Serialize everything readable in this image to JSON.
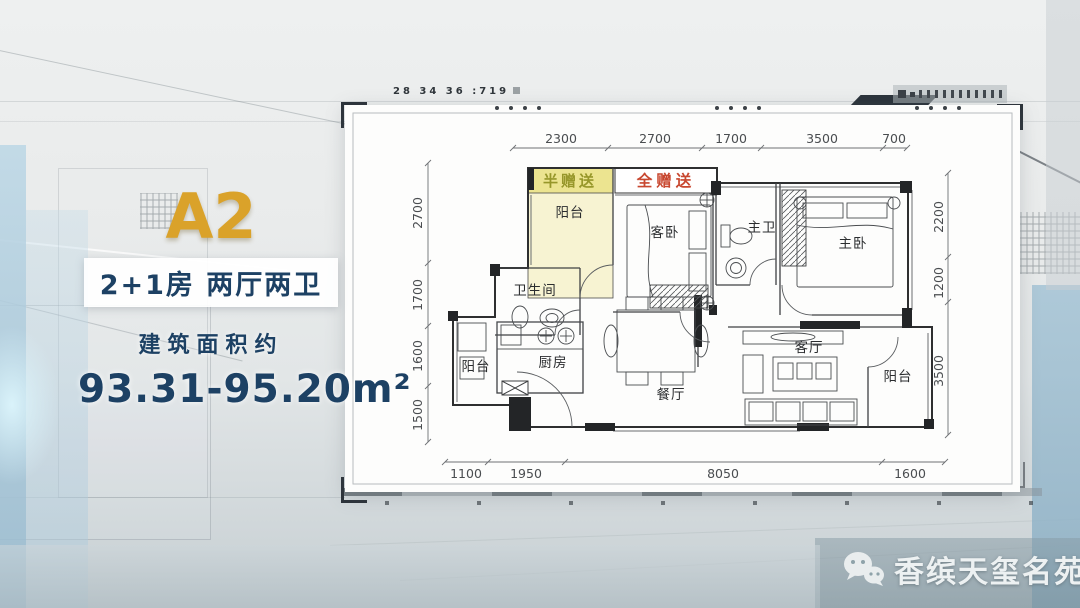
{
  "panel": {
    "unit": "A2",
    "layout": "2+1房  两厅两卫",
    "area_label": "建筑面积约",
    "area_value": "93.31-95.20m²"
  },
  "plan": {
    "gift_half": "半赠送",
    "gift_full": "全赠送",
    "rooms": {
      "balcony_top": "阳台",
      "guest_bedroom": "客卧",
      "master_bath": "主卫",
      "master_bedroom": "主卧",
      "bathroom": "卫生间",
      "kitchen": "厨房",
      "balcony_left": "阳台",
      "dining": "餐厅",
      "living": "客厅",
      "balcony_right": "阳台"
    },
    "top_dims": [
      "2300",
      "2700",
      "1700",
      "3500",
      "700"
    ],
    "left_dims": [
      "2700",
      "1700",
      "1600",
      "1500"
    ],
    "right_dims": [
      "2200",
      "1200",
      "3500"
    ],
    "bottom_dims": [
      "1100",
      "1950",
      "8050",
      "1600"
    ]
  },
  "hud": {
    "ticker": "28 34 36 :719"
  },
  "watermark": {
    "icon": "wechat-icon",
    "brand": "香缤天玺名苑"
  },
  "colors": {
    "gold": "#daa22a",
    "navy": "#1d4164",
    "gift_red": "#c8472f",
    "gift_olive": "#97972a",
    "balcony_yellow": "#f7f3d2",
    "wall_dark": "#232527"
  }
}
